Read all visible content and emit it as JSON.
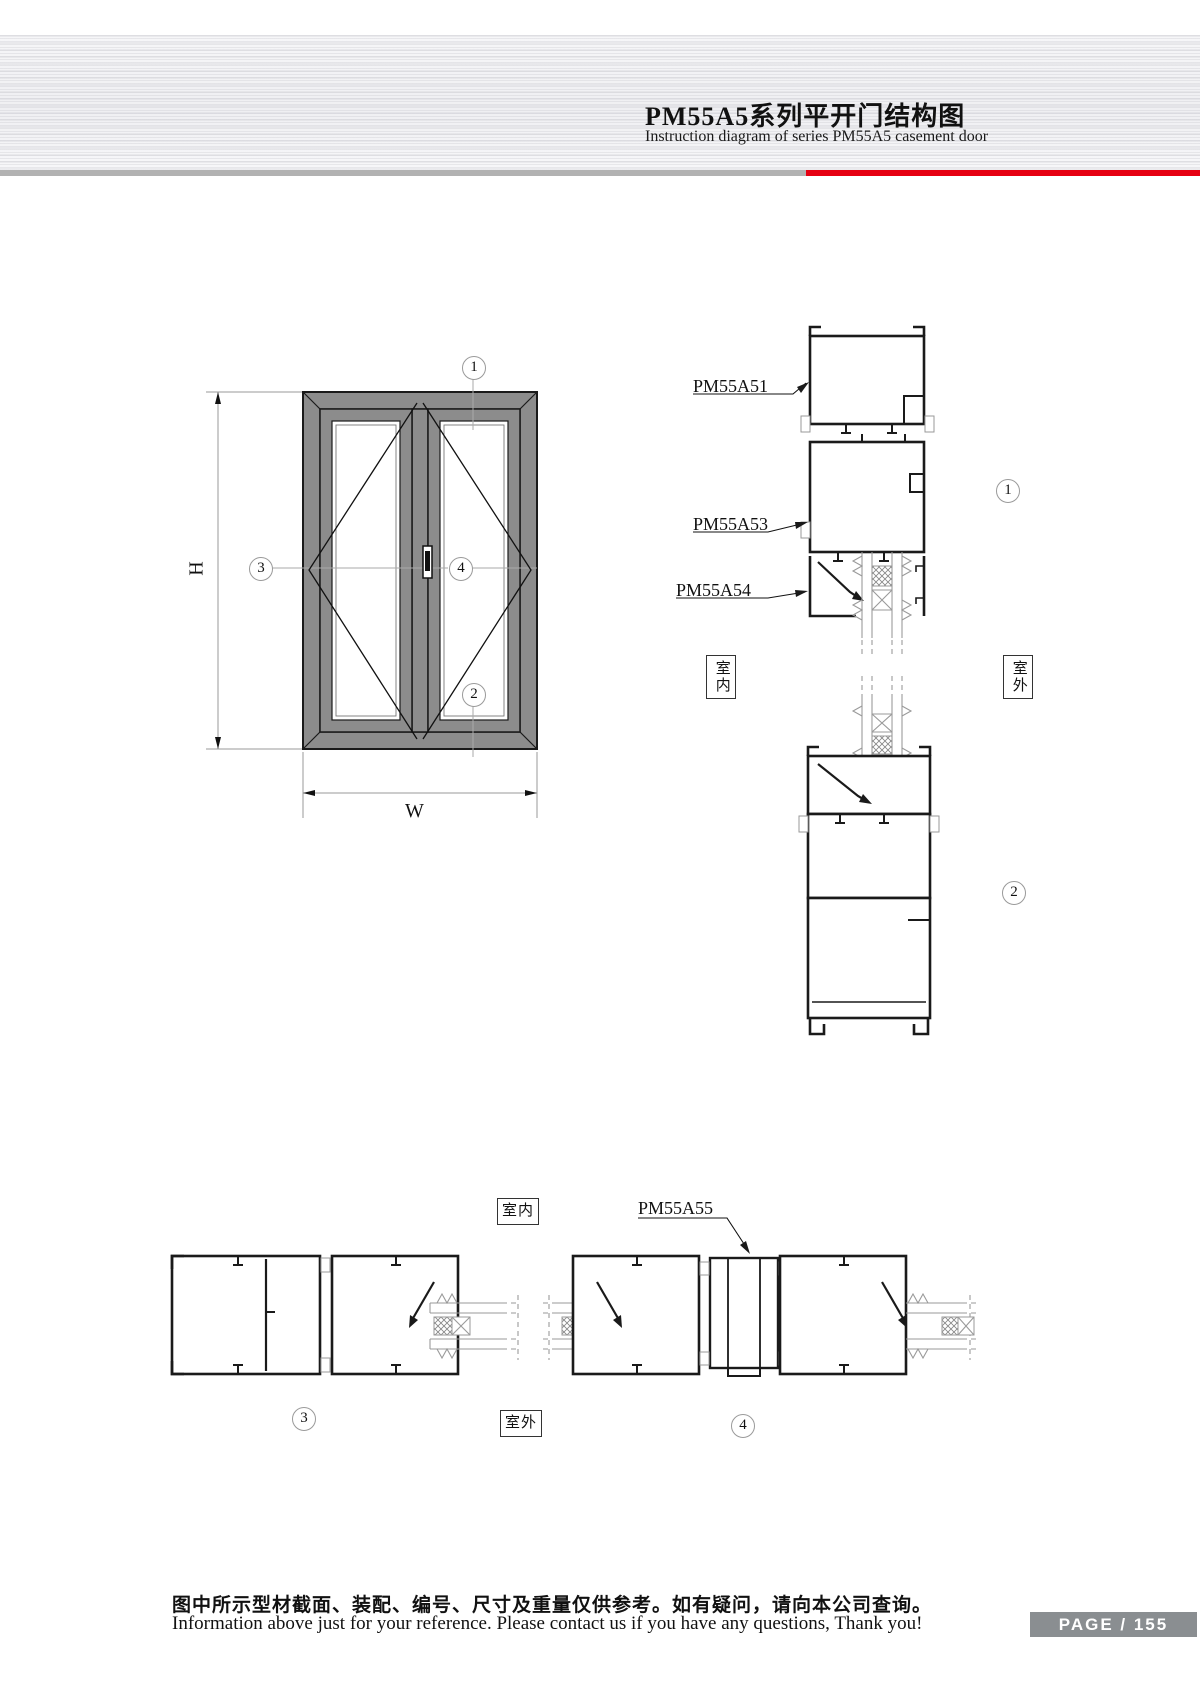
{
  "header": {
    "title_cn": "PM55A5系列平开门结构图",
    "title_en": "Instruction diagram of series PM55A5 casement door"
  },
  "colors": {
    "accent_red": "#e60012",
    "rule_gray": "#b2b2b2",
    "frame_gray": "#8c8c8c",
    "badge_gray": "#8a8e91"
  },
  "front_view": {
    "dim_height": "H",
    "dim_width": "W"
  },
  "callouts": {
    "front_top": "1",
    "front_bottom": "2",
    "front_left": "3",
    "front_center": "4",
    "sec1": "1",
    "sec2": "2",
    "sec3": "3",
    "sec4": "4"
  },
  "profiles": {
    "a51": "PM55A51",
    "a53": "PM55A53",
    "a54": "PM55A54",
    "a55": "PM55A55"
  },
  "orientation": {
    "indoor": "室内",
    "outdoor": "室外"
  },
  "footer": {
    "note_cn": "图中所示型材截面、装配、编号、尺寸及重量仅供参考。如有疑问，请向本公司查询。",
    "note_en": "Information above just for your reference. Please contact us if you have any questions, Thank you!",
    "page_badge": "PAGE / 155"
  }
}
